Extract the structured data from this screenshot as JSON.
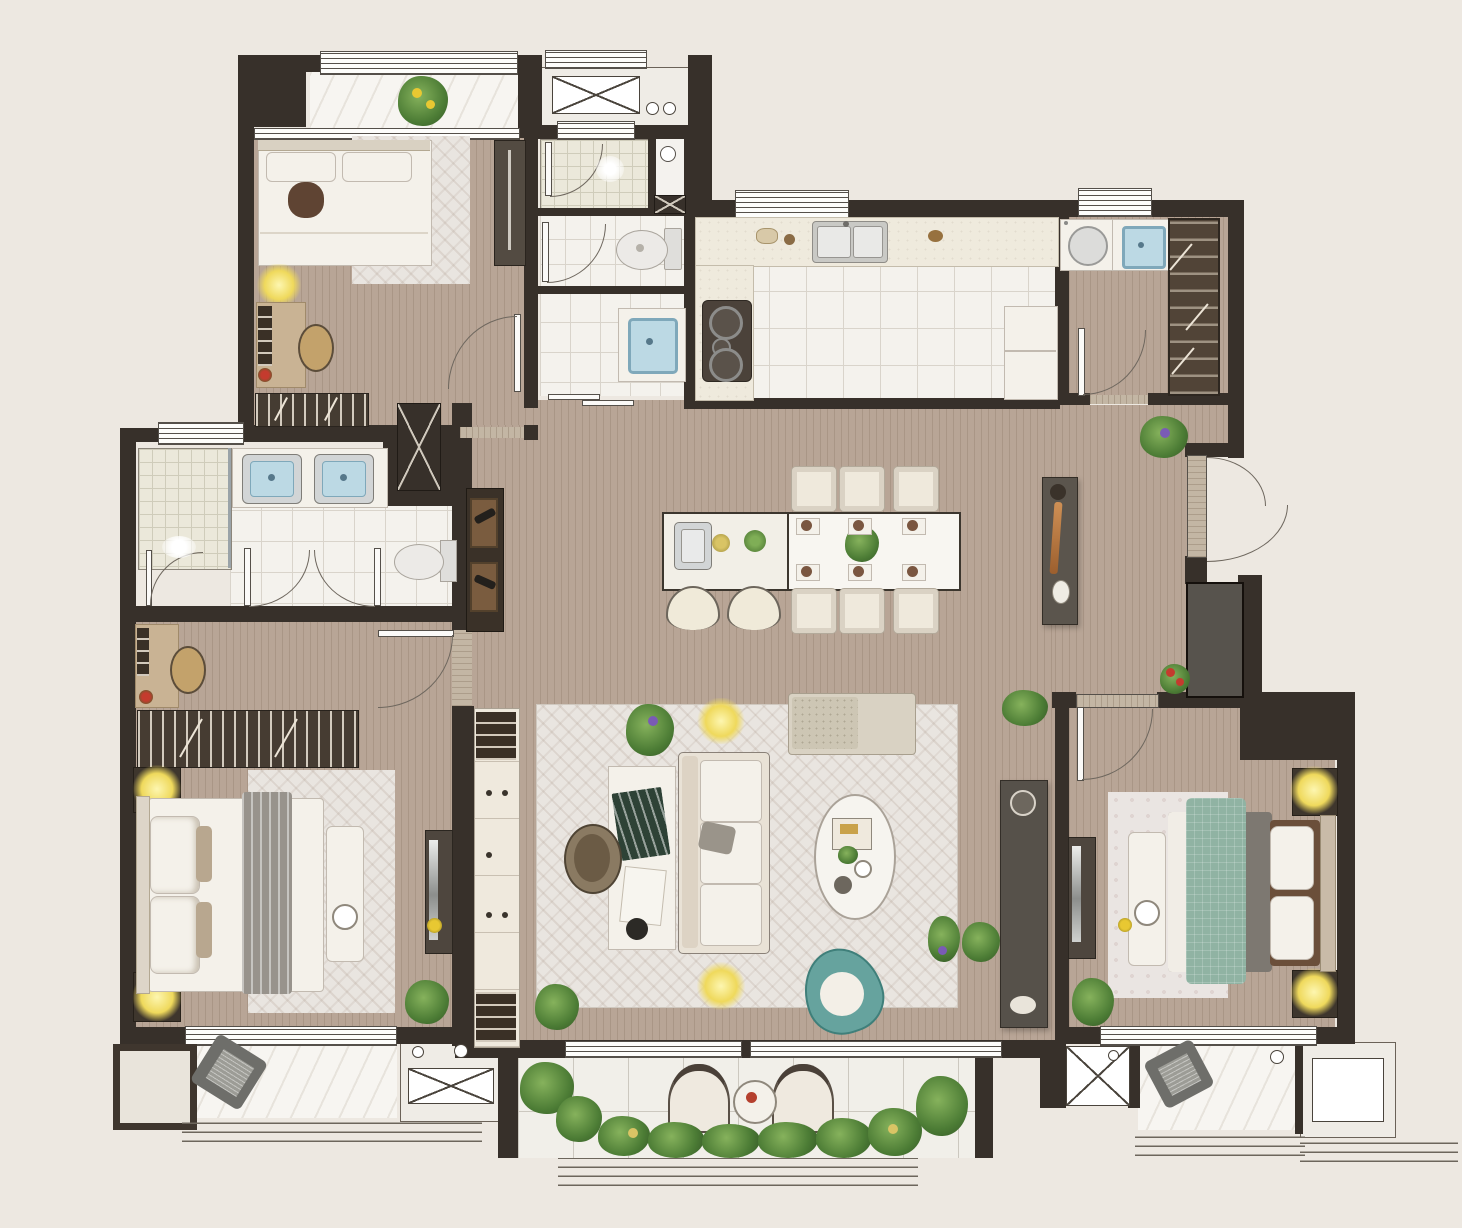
{
  "document": {
    "title": "Apartment Floor Plan",
    "type": "rendered top-down architectural floor plan",
    "visible_text": "none (graphic only)"
  },
  "palette": {
    "background": "#ede8e1",
    "walls": "#37302a",
    "wood_floor": "#b8a596",
    "tile_floor": "#f4f2ed",
    "marble_floor": "#f7f5f1",
    "rug": "#e9e5e0",
    "counter": "#efeadd",
    "stone_threshold": "#c3b6a4",
    "sink_blue": "#bcd9e4",
    "lamp_glow": "#efd95c",
    "plant_green": "#4c7c35",
    "teal_chair": "#66a39e",
    "green_bed_cover": "#90b3a3",
    "dark_cabinet": "#4e463e"
  },
  "rooms": [
    {
      "name": "bedroom-top-left",
      "floor": "wood",
      "furniture": [
        "double bed with white linen and brown accent pillow",
        "area rug",
        "wardrobe",
        "writing desk with books",
        "round stool",
        "lit table lamp",
        "bookshelf",
        "swing door"
      ]
    },
    {
      "name": "guest-bathroom-block",
      "floor": "tile",
      "furniture": [
        "glass shower room with door",
        "vent niche",
        "toilet compartment with toilet",
        "wash room with blue basin vanity",
        "sliding door"
      ]
    },
    {
      "name": "kitchen",
      "floor": "tile",
      "furniture": [
        "L-shaped counter",
        "double-bowl sink",
        "gas cooktop with three burners",
        "refrigerator",
        "counter dishes",
        "window"
      ]
    },
    {
      "name": "laundry-room",
      "floor": "wood",
      "furniture": [
        "washing machine",
        "utility sink with blue basin",
        "tall wardrobe cabinet with hanging rail",
        "swing door",
        "window"
      ]
    },
    {
      "name": "dining-area",
      "floor": "wood",
      "furniture": [
        "kitchen island with bar sink",
        "two bar stools",
        "fruit bowls",
        "dining table for six",
        "six upholstered chairs",
        "six place settings",
        "centerpiece plant",
        "console table with copper decor and vase"
      ]
    },
    {
      "name": "living-room",
      "floor": "wood",
      "furniture": [
        "large herringbone rug",
        "three-seat sofa",
        "daybed chaise",
        "oval coffee table with books",
        "teal barrel armchair",
        "work desk with books and papers",
        "desk chair",
        "two lit floor lamps",
        "TV console with decor",
        "built-in bookcase",
        "potted plants"
      ]
    },
    {
      "name": "master-bathroom",
      "floor": "tile",
      "furniture": [
        "glass shower enclosure with shower head",
        "double vanity with two blue sinks",
        "toilet",
        "double swing doors",
        "wine display cabinet with bottles",
        "service shaft",
        "window"
      ]
    },
    {
      "name": "master-bedroom",
      "floor": "wood",
      "furniture": [
        "king bed with gray striped runner",
        "two nightstands with lit lamps",
        "bench with tray",
        "area rug",
        "long bookshelf",
        "small desk with books and red flower",
        "stool",
        "wall TV panel",
        "potted plant",
        "entry door with stone threshold"
      ]
    },
    {
      "name": "bedroom-right",
      "floor": "wood",
      "furniture": [
        "double bed with green quilt",
        "headboard",
        "two nightstands with lit lamps",
        "bench at foot of bed",
        "TV bench",
        "area rug",
        "potted plant",
        "swing door"
      ]
    },
    {
      "name": "entry-hall",
      "floor": "wood",
      "furniture": [
        "entry door with stone threshold and double swing arcs",
        "service shaft with X mark",
        "potted plant",
        "red flower pot"
      ]
    }
  ],
  "outdoor_areas": [
    {
      "name": "balcony-top-left",
      "features": [
        "marble floor",
        "yellow flowering plant",
        "window rail"
      ]
    },
    {
      "name": "equipment-platform-top",
      "features": [
        "AC unit outline with X",
        "two pipe circles"
      ]
    },
    {
      "name": "main-balcony",
      "features": [
        "tile floor",
        "two shell armchairs",
        "round tea table with red decor",
        "planting beds with shrubs",
        "railing"
      ]
    },
    {
      "name": "balcony-bottom-left",
      "features": [
        "marble floor",
        "gray cushion",
        "railing",
        "side niche"
      ]
    },
    {
      "name": "equipment-platform-bottom-left",
      "features": [
        "AC unit outline with X",
        "two pipe circles"
      ]
    },
    {
      "name": "balcony-bottom-right",
      "features": [
        "marble floor",
        "gray cushion",
        "railing"
      ]
    },
    {
      "name": "equipment-platform-bottom-right",
      "features": [
        "AC unit outline",
        "pipe circle",
        "railing"
      ]
    }
  ],
  "fixtures": {
    "doors": [
      "bedroom-top-left-door",
      "shower-door",
      "toilet-room-door",
      "laundry-door",
      "bedroom-right-door",
      "master-bedroom-door",
      "master-bath-double-doors",
      "entry-double-door",
      "wash-room-sliding-door"
    ],
    "windows": [
      "balcony-top-left-window",
      "platform-top-window",
      "kitchen-window",
      "laundry-window",
      "master-bath-window",
      "master-bedroom-window",
      "living-room-sliding-windows",
      "bedroom-right-window"
    ]
  }
}
